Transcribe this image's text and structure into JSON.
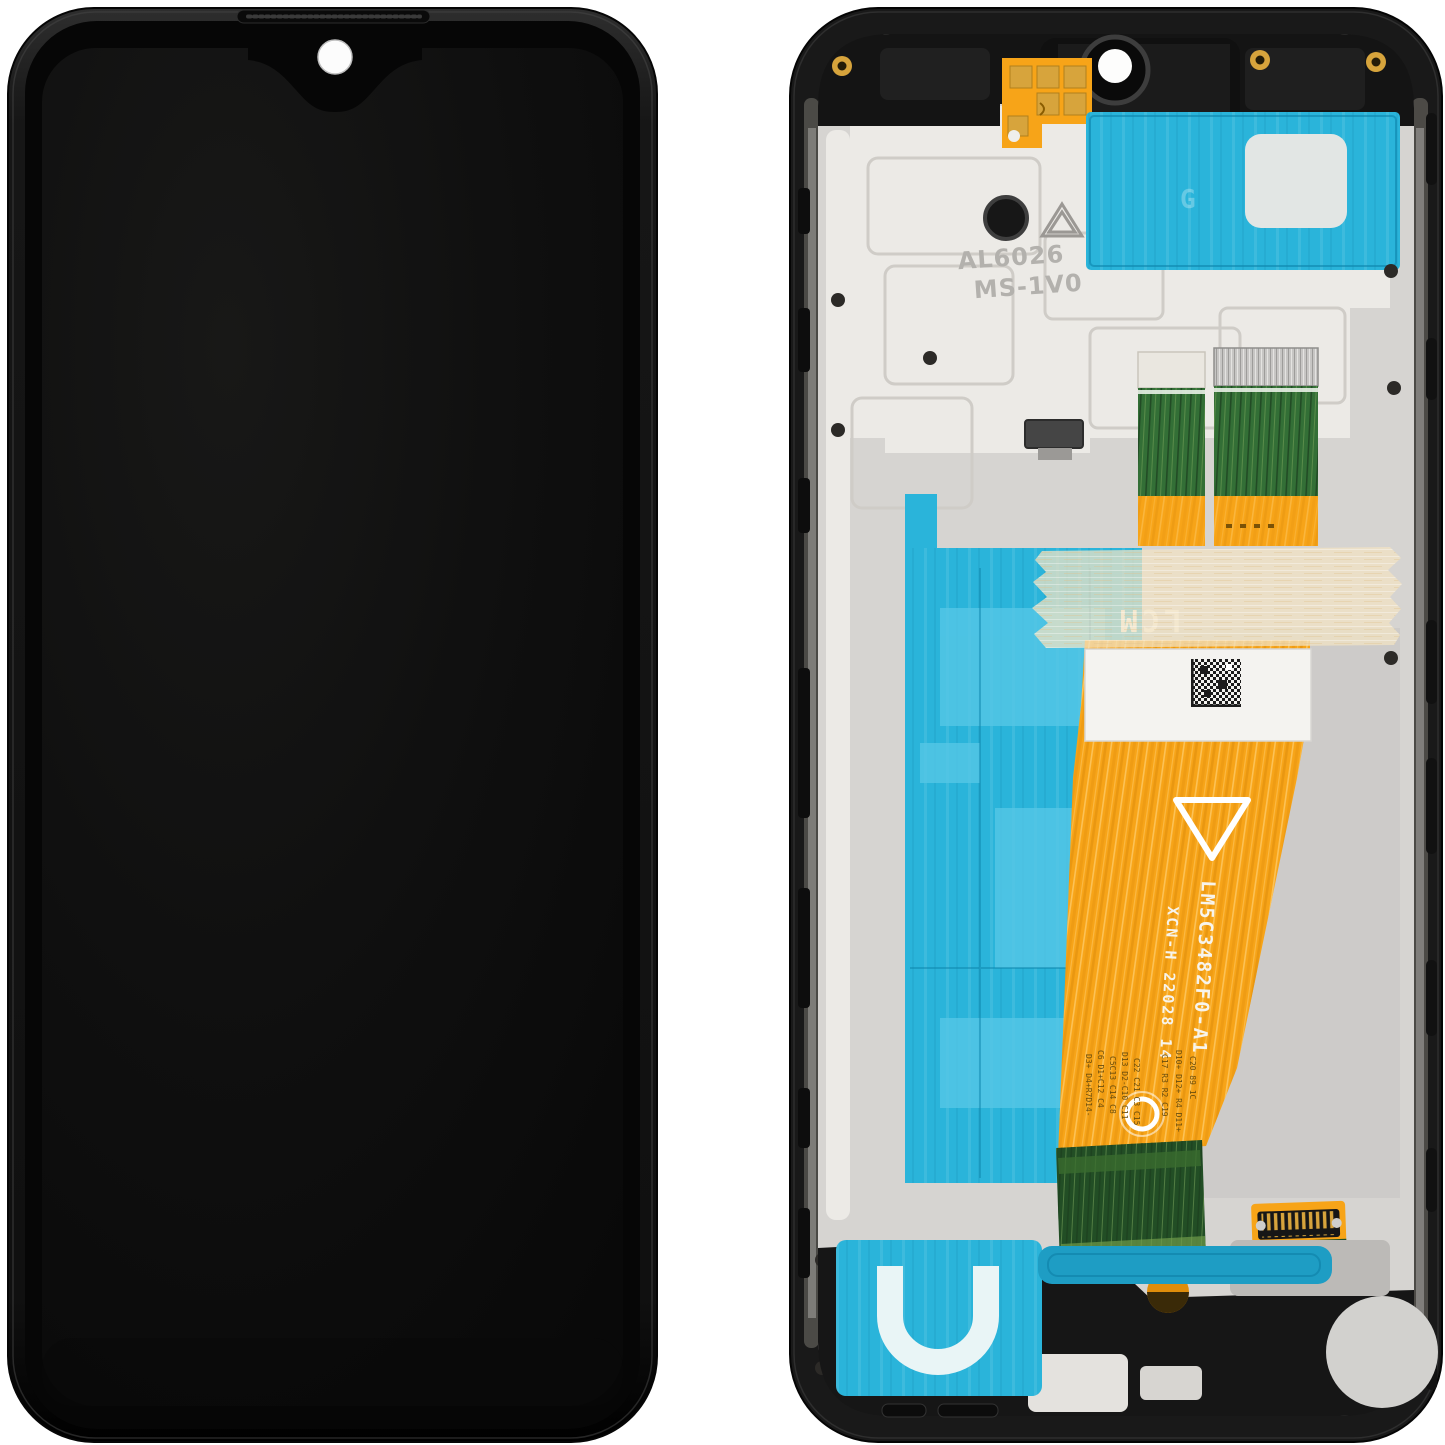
{
  "scene": {
    "type": "product-photo",
    "subject": "Phone LCD display module with frame, front view and back view",
    "background": "#ffffff"
  },
  "front_view": {
    "description": "assembled display front, screen off",
    "features": [
      "earpiece-grille",
      "teardrop-notch",
      "front-camera-hole"
    ]
  },
  "back_view": {
    "markings": {
      "frame_line1": "AL6026",
      "frame_line2": "MS-1V0",
      "adhesive_watermark": "G",
      "lcm_label": "LCM",
      "flex_part_number": "LM5C3482F0-A1",
      "flex_batch_code": "XCN-H 22028 14",
      "connector_marking_left": "40",
      "connector_marking_right": "21",
      "component_labels": [
        "D3+ D4+R7D14-",
        "C6 D1+C12 C4",
        "C5C13 C14 C8",
        "D13 D2-C10 C11",
        "C22 C21 C3 C15",
        "C17 R3 R2 C19",
        "D10+ D12+ R4 D11+",
        "C20 89 1C"
      ]
    }
  },
  "colors": {
    "bg": "#ffffff",
    "frame": "#191919",
    "frame_hi": "#3a3a3a",
    "bezel": "#060606",
    "screen": "#0e0e0e",
    "screen_hi": "#181818",
    "metal": "#d6d4d1",
    "metal_dark": "#c3c1be",
    "plastic": "#eceae6",
    "cyan": "#2ab4da",
    "cyan_light": "#55c7e6",
    "cyan_dark": "#1e9dc4",
    "orange": "#f7a418",
    "orange_dark": "#df8d0b",
    "gold": "#d7a43c",
    "green": "#336f36",
    "green_dark": "#224e25",
    "tape": "rgba(241,227,195,0.74)",
    "label": "#f4f3f0",
    "white_ink": "#f7f4ec",
    "emboss": "#b3b1ad"
  }
}
